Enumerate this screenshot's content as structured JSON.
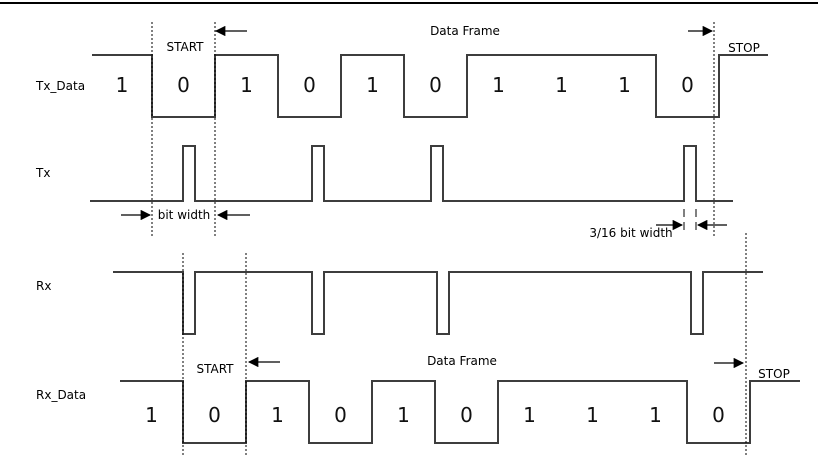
{
  "signals": {
    "tx_data": {
      "label": "Tx_Data",
      "bits": [
        "1",
        "0",
        "1",
        "0",
        "1",
        "0",
        "1",
        "1",
        "1",
        "0"
      ]
    },
    "tx": {
      "label": "Tx"
    },
    "rx": {
      "label": "Rx"
    },
    "rx_data": {
      "label": "Rx_Data",
      "bits": [
        "1",
        "0",
        "1",
        "0",
        "1",
        "0",
        "1",
        "1",
        "1",
        "0"
      ]
    }
  },
  "annotations": {
    "start_top": "START",
    "data_frame_top": "Data Frame",
    "stop_top": "STOP",
    "bit_width": "bit width",
    "three_sixteenths_bit_width": "3/16 bit width",
    "start_bottom": "START",
    "data_frame_bottom": "Data Frame",
    "stop_bottom": "STOP"
  },
  "colors": {
    "waveform_line": "#3d3d3d",
    "guide_line": "#000000",
    "text": "#000000",
    "background": "#ffffff"
  }
}
